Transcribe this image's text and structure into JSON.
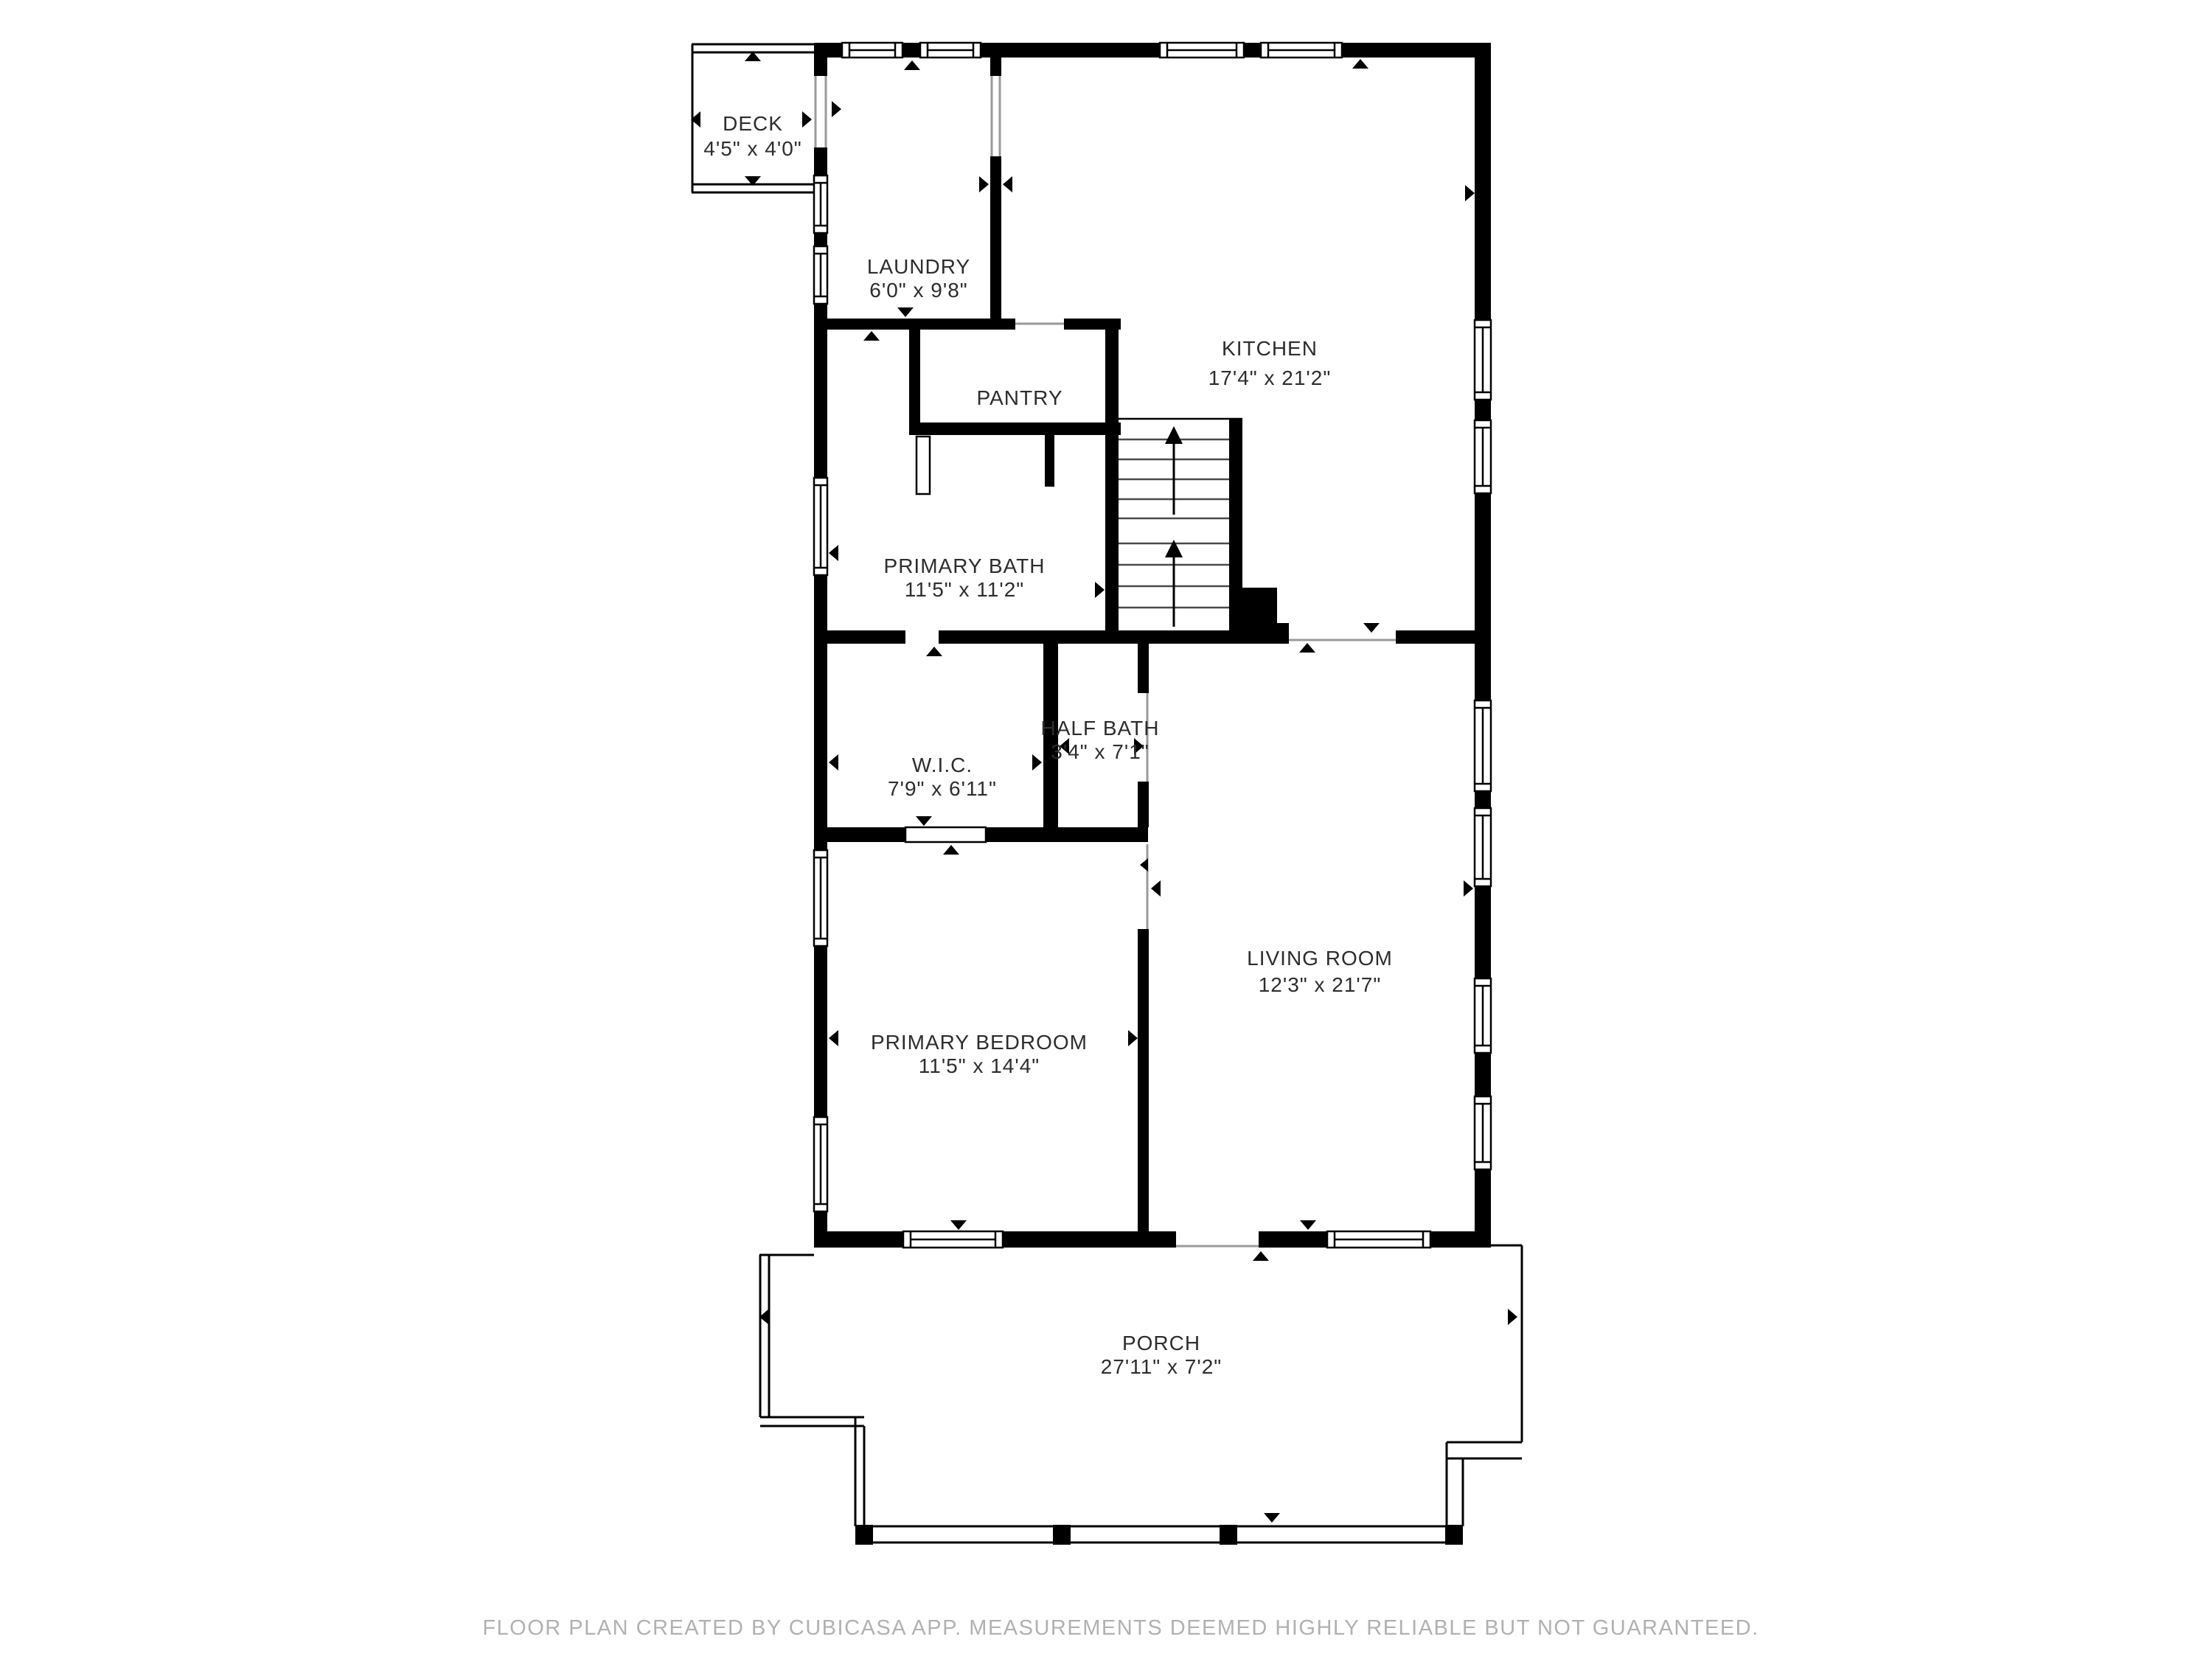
{
  "footer": "FLOOR PLAN CREATED BY CUBICASA APP. MEASUREMENTS DEEMED HIGHLY RELIABLE BUT NOT GUARANTEED.",
  "colors": {
    "wall": "#000000",
    "label": "#2d2d2d",
    "footer_gray": "#b1b1b1",
    "background": "#ffffff"
  },
  "rooms": [
    {
      "id": "deck",
      "name": "DECK",
      "dims": "4'5\" x 4'0\""
    },
    {
      "id": "laundry",
      "name": "LAUNDRY",
      "dims": "6'0\" x 9'8\""
    },
    {
      "id": "kitchen",
      "name": "KITCHEN",
      "dims": "17'4\" x 21'2\""
    },
    {
      "id": "pantry",
      "name": "PANTRY",
      "dims": ""
    },
    {
      "id": "primary-bath",
      "name": "PRIMARY BATH",
      "dims": "11'5\" x 11'2\""
    },
    {
      "id": "wic",
      "name": "W.I.C.",
      "dims": "7'9\" x 6'11\""
    },
    {
      "id": "half-bath",
      "name": "HALF BATH",
      "dims": "3'4\" x 7'1\""
    },
    {
      "id": "living-room",
      "name": "LIVING ROOM",
      "dims": "12'3\" x 21'7\""
    },
    {
      "id": "primary-bedroom",
      "name": "PRIMARY BEDROOM",
      "dims": "11'5\" x 14'4\""
    },
    {
      "id": "porch",
      "name": "PORCH",
      "dims": "27'11\" x 7'2\""
    }
  ],
  "stairs": {
    "up_arrow_count": 2,
    "direction": "up"
  }
}
